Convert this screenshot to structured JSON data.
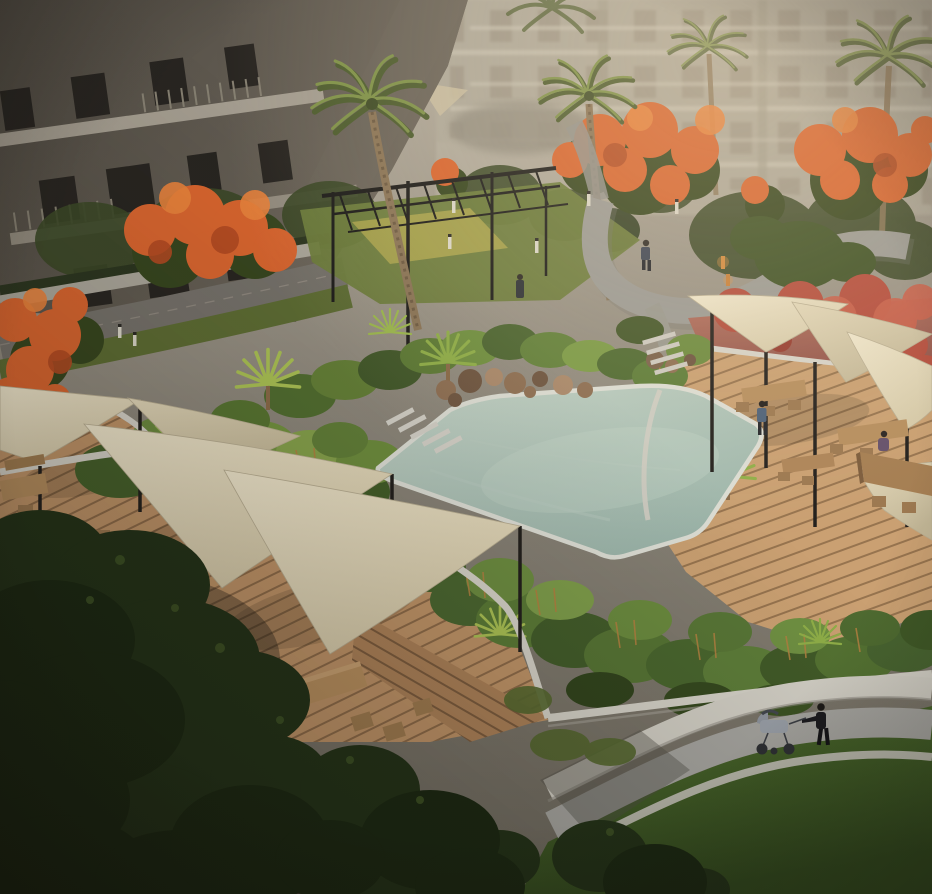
{
  "scene": {
    "type": "architectural-rendering-aerial-view",
    "setting": "Residential community courtyard with free-form pool, tropical planting, timber decks, triangular shade sails, picnic tables, curved walking paths, flame trees and mid-rise apartment buildings",
    "lighting": "hazy warm late-afternoon light, deep shade lower-left",
    "people": [
      {
        "role": "man-walking-on-upper-path"
      },
      {
        "role": "person-standing-near-planting"
      },
      {
        "role": "woman-standing-on-right-deck"
      },
      {
        "role": "man-seated-at-right-deck-table"
      },
      {
        "role": "woman-pushing-stroller-on-lower-path"
      }
    ],
    "objects": [
      "apartment-building-left",
      "apartment-buildings-background",
      "flame-trees",
      "palm-trees",
      "black-steel-pergola",
      "play-pad",
      "street-with-hedge",
      "curved-walking-path",
      "bollard-lights",
      "free-form-pool",
      "rock-feature",
      "stepping-stones",
      "tropical-planting-beds",
      "fan-palms",
      "timber-deck-left",
      "timber-deck-right",
      "white-planter-walls",
      "pink-terrace-bank",
      "red-foliage",
      "shade-sails",
      "sail-posts",
      "picnic-tables",
      "stools",
      "stroller",
      "lower-footpath-with-curbs",
      "lawn",
      "dark-pavement",
      "foreground-trees"
    ]
  },
  "colors": {
    "haze_top": "#b6ae9f",
    "haze_mid": "#8e887c",
    "haze_low": "#6f6a5f",
    "building_left_dark": "#4e4941",
    "building_left_light": "#6e675c",
    "window_dark": "#282521",
    "building_right": "#a49d8f",
    "window_right": "#8a8173",
    "balcony_slab": "#c8c1b3",
    "flame_orange": "#d8652f",
    "flame_orange_bright": "#e8823c",
    "flame_orange_deep": "#b24a22",
    "flame_canopy_green": "#37461f",
    "palm_frond_dark": "#4d5c2e",
    "palm_frond_light": "#7e9148",
    "palm_trunk": "#8a7456",
    "pergola_black": "#1d1c1a",
    "play_pad": "#b0a74f",
    "pergola_lawn": "#6d7c3c",
    "road": "#75716a",
    "sidewalk": "#aaa69a",
    "hedge": "#2c3620",
    "verge_green": "#5d6c33",
    "path_gray": "#9b9a94",
    "step_white": "#ccc9c0",
    "planting_dark": "#33431f",
    "planting_mid": "#567431",
    "planting_light": "#7fa04a",
    "stem_brown": "#b08040",
    "fanpalm_green": "#aac154",
    "pool_rim": "#dcddd4",
    "pool_light": "#c2d2c6",
    "pool_deep": "#9ab3a8",
    "rock_brown": "#8d6e52",
    "plank_light": "#c09468",
    "plank_gap": "#8e6b49",
    "plank_right": "#caa072",
    "plank_right_gap": "#97744f",
    "plank_bottom": "#ad8259",
    "plank_bottom_gap": "#7c5c3e",
    "planter_wall_white": "#d5d2c8",
    "pink_bank_light": "#b4705e",
    "pink_bank_deep": "#92544a",
    "red_foliage": "#b44c3c",
    "sail_light": "#efe6cc",
    "sail_shade": "#d6caa9",
    "sail_dark1": "#e3d8ba",
    "sail_dark2": "#c2b696",
    "sail_post": "#221f1c",
    "table_wood": "#b68e5e",
    "table_side": "#8a6844",
    "lawn_light": "#51702f",
    "lawn_dark": "#324a1e",
    "footpath": "#a6a5a0",
    "curb_white": "#d2cfc5",
    "pavement_dark": "#474236",
    "pavement_deep": "#2f2b25",
    "tree_dark": "#233218",
    "tree_deep": "#1b2812",
    "bollard": "#dad6c8",
    "bollard_orange": "#d28a3e",
    "person_navy": "#3c4454",
    "person_blue": "#4c6078",
    "person_purple": "#64506b",
    "person_black": "#1b1b1f",
    "stroller_gray": "#9aa0a8"
  }
}
